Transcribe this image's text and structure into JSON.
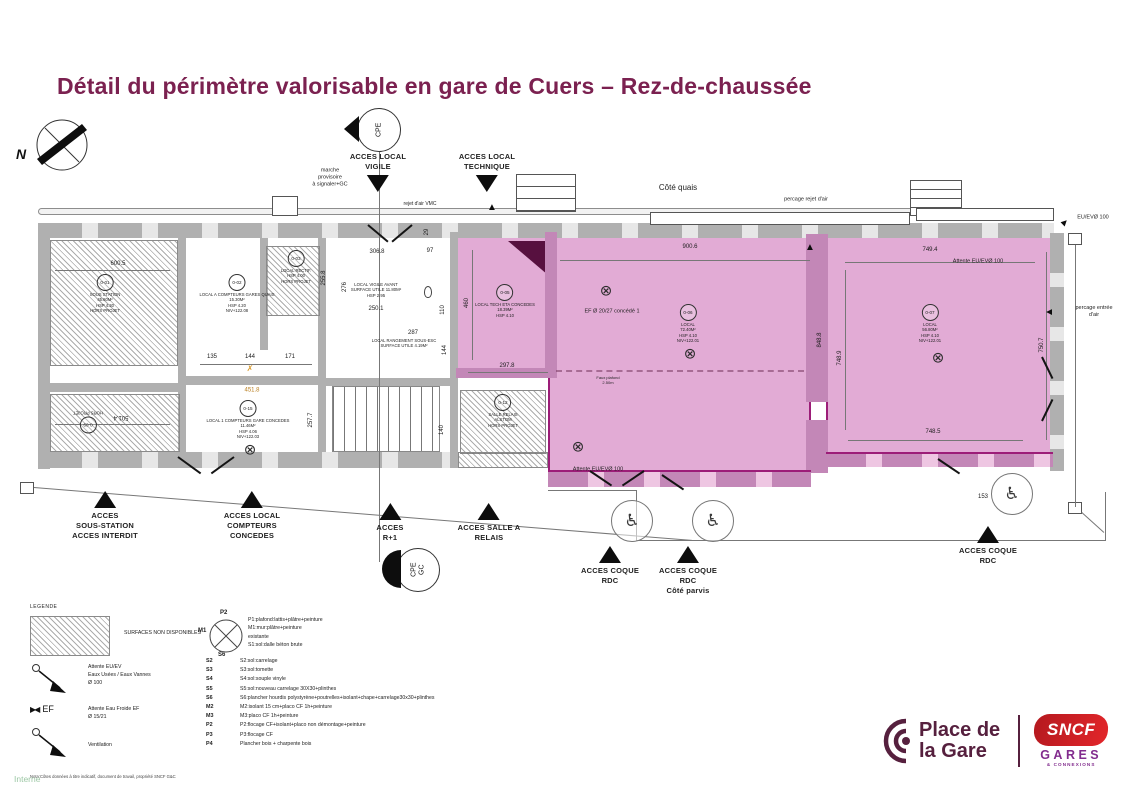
{
  "header": {
    "title": "Détail du périmètre valorisable en gare de Cuers – Rez-de-chaussée"
  },
  "compass": {
    "north": "N"
  },
  "cpe_top": {
    "label": "CPE"
  },
  "cpe_gc": {
    "label": "CPE\nGC"
  },
  "colors": {
    "title": "#7b2150",
    "valorisable_fill": "#e2abd5",
    "valorisable_outline": "#9c1d78",
    "wall_grey": "#b0b0b0",
    "sncf_red": "#d2232a",
    "gares_purple": "#822c8e",
    "logo_maroon": "#56203e",
    "interne_green": "#9cc7a4"
  },
  "plan": {
    "dimensions": [
      {
        "t": "900.6",
        "x": 690,
        "y": 247
      },
      {
        "t": "749.4",
        "x": 930,
        "y": 250
      },
      {
        "t": "748.5",
        "x": 933,
        "y": 432
      },
      {
        "t": "748.9",
        "x": 840,
        "y": 358,
        "r": -90
      },
      {
        "t": "750.7",
        "x": 1042,
        "y": 345,
        "r": -90
      },
      {
        "t": "848.8",
        "x": 820,
        "y": 340,
        "r": -90
      },
      {
        "t": "460",
        "x": 467,
        "y": 303,
        "r": -90
      },
      {
        "t": "297.8",
        "x": 507,
        "y": 366
      },
      {
        "t": "306.8",
        "x": 377,
        "y": 252
      },
      {
        "t": "250.1",
        "x": 376,
        "y": 309
      },
      {
        "t": "276",
        "x": 345,
        "y": 287,
        "r": -90
      },
      {
        "t": "110",
        "x": 443,
        "y": 310,
        "r": -90
      },
      {
        "t": "97",
        "x": 430,
        "y": 251
      },
      {
        "t": "29",
        "x": 427,
        "y": 232,
        "r": -90
      },
      {
        "t": "287",
        "x": 413,
        "y": 333
      },
      {
        "t": "144",
        "x": 445,
        "y": 350,
        "r": -90
      },
      {
        "t": "140",
        "x": 442,
        "y": 430,
        "r": -90
      },
      {
        "t": "135",
        "x": 212,
        "y": 357
      },
      {
        "t": "144",
        "x": 250,
        "y": 357
      },
      {
        "t": "171",
        "x": 290,
        "y": 357
      },
      {
        "t": "600.5",
        "x": 118,
        "y": 264
      },
      {
        "t": "501.4",
        "x": 121,
        "y": 417,
        "r": 180
      },
      {
        "t": "257.7",
        "x": 311,
        "y": 420,
        "r": -90
      },
      {
        "t": "255.8",
        "x": 324,
        "y": 278,
        "r": -90
      },
      {
        "t": "153",
        "x": 983,
        "y": 497
      }
    ],
    "notes": [
      {
        "t": "marche\nprovisoire\nà signaler+GC",
        "x": 330,
        "y": 178,
        "s": 5.5
      },
      {
        "t": "rejet d'air VMC",
        "x": 420,
        "y": 204,
        "s": 5
      },
      {
        "t": "Côté quais",
        "x": 678,
        "y": 188,
        "s": 8
      },
      {
        "t": "percage rejet d'air",
        "x": 806,
        "y": 200,
        "s": 5.5
      },
      {
        "t": "EU/EVØ 100",
        "x": 1093,
        "y": 218,
        "s": 5.5
      },
      {
        "t": "Attente EU/EVØ 100",
        "x": 978,
        "y": 262,
        "s": 5.5
      },
      {
        "t": "percage entrée d'air",
        "x": 1094,
        "y": 312,
        "s": 5.5
      },
      {
        "t": "EF Ø 20/27 concédé 1",
        "x": 612,
        "y": 312,
        "s": 5.5
      },
      {
        "t": "Attente EU/EVØ 100",
        "x": 598,
        "y": 470,
        "s": 5.5
      },
      {
        "t": "Faux plafond\n2.50m",
        "x": 608,
        "y": 380,
        "s": 4
      },
      {
        "t": "LOCAL VIGILE AVANT\nSURFACE UTILE 11.80M²\nHSP 2.95",
        "x": 376,
        "y": 290,
        "s": 4.3
      },
      {
        "t": "LOCAL RANGEMENT SOUS-ESC\nSURFACE UTILE 4.19M²",
        "x": 404,
        "y": 343,
        "s": 4.2
      },
      {
        "t": "451.8",
        "x": 252,
        "y": 391,
        "s": 6,
        "c": "#b97e1e"
      },
      {
        "t": "✗",
        "x": 250,
        "y": 369,
        "s": 8,
        "c": "#d99a2b"
      }
    ],
    "arrows": [
      {
        "x": 810,
        "y": 248,
        "r": 0
      },
      {
        "x": 1064,
        "y": 223,
        "r": 45
      },
      {
        "x": 1050,
        "y": 312,
        "r": -90
      },
      {
        "x": 492,
        "y": 208,
        "r": 0
      }
    ],
    "lights": [
      {
        "x": 606,
        "y": 291
      },
      {
        "x": 690,
        "y": 354
      },
      {
        "x": 578,
        "y": 447
      },
      {
        "x": 938,
        "y": 358
      },
      {
        "x": 250,
        "y": 450
      }
    ],
    "wheelchairs": [
      {
        "x": 632,
        "y": 521
      },
      {
        "x": 713,
        "y": 521
      },
      {
        "x": 1012,
        "y": 494
      }
    ],
    "rooms": [
      {
        "id": "0-01",
        "text": "SOUS STATION\n45.80M²\nHSP 4.30\nHORS PROJET",
        "x": 105,
        "y": 282
      },
      {
        "id": "0-02",
        "text": "LOCAL A COMPTEURS GARES QUAIS\n15.30M²\nHSP 4.20\nNIV+122.08",
        "x": 237,
        "y": 282
      },
      {
        "id": "0-03",
        "text": "LOCAL RECTIF.\nHSP 4.00\nHORS PROJET",
        "x": 296,
        "y": 258
      },
      {
        "id": "0-05",
        "text": "LOCAL TECH ETA CONCEDES\n18.39M²\nHSP 4.10",
        "x": 505,
        "y": 292
      },
      {
        "id": "0-06",
        "text": "LOCAL\n72.40M²\nHSP 4.10\nNIV+122.01",
        "x": 688,
        "y": 312
      },
      {
        "id": "0-07",
        "text": "LOCAL\n56.80M²\nHSP 4.10\nNIV+122.01",
        "x": 930,
        "y": 312
      },
      {
        "id": "0-09",
        "text": "HORS PROJET",
        "x": 88,
        "y": 418,
        "rot": 180
      },
      {
        "id": "0-12",
        "text": "SALLE RELAIS\nALSTOM\nHORS PROJET",
        "x": 503,
        "y": 402
      },
      {
        "id": "0-15",
        "text": "LOCAL 1 COMPTEURS GARE CONCEDES\n11.46M²\nHSP 4.06\nNIV+122.03",
        "x": 248,
        "y": 408
      }
    ],
    "access": [
      {
        "t": "ACCES LOCAL\nVIGILE",
        "x": 378,
        "y": 152,
        "dir": "down"
      },
      {
        "t": "ACCES LOCAL\nTECHNIQUE",
        "x": 487,
        "y": 152,
        "dir": "down"
      },
      {
        "t": "ACCES\nSOUS-STATION\nACCES INTERDIT",
        "x": 105,
        "y": 488,
        "dir": "up"
      },
      {
        "t": "ACCES LOCAL\nCOMPTEURS\nCONCEDES",
        "x": 252,
        "y": 488,
        "dir": "up"
      },
      {
        "t": "ACCES\nR+1",
        "x": 390,
        "y": 500,
        "dir": "up"
      },
      {
        "t": "ACCES SALLE A\nRELAIS",
        "x": 489,
        "y": 500,
        "dir": "up"
      },
      {
        "t": "ACCES COQUE\nRDC",
        "x": 610,
        "y": 543,
        "dir": "up"
      },
      {
        "t": "ACCES COQUE\nRDC\nCôté parvis",
        "x": 688,
        "y": 543,
        "dir": "up"
      },
      {
        "t": "ACCES COQUE\nRDC",
        "x": 988,
        "y": 523,
        "dir": "up"
      }
    ]
  },
  "legend": {
    "title": "LEGENDE",
    "hatch_label": "SURFACES NON DISPONIBLES",
    "eu_ev": "Attente EU/EV\nEaux Usées / Eaux Vannes\nØ 100",
    "ef_symbol": "EF",
    "ef": "Attente Eau Froide EF\nØ 15/21",
    "ventilation": "Ventilation",
    "note": "Nota:Côtes données à titre indicatif, document de travail, propriété SNCF G&C"
  },
  "materials": {
    "symbol": {
      "top": "P2",
      "left": "M1",
      "bottom": "S6"
    },
    "header": "P1:plafond:lattis+plâtre+peinture\nM1:mur:plâtre+peinture existante\nS1:sol:dalle béton brute",
    "rows": [
      {
        "code": "S2",
        "desc": "S2:sol:carrelage"
      },
      {
        "code": "S3",
        "desc": "S3:sol:tomette"
      },
      {
        "code": "S4",
        "desc": "S4:sol:souple vinyle"
      },
      {
        "code": "S5",
        "desc": "S5:sol:nouveau carrelage 30X30+plinthes"
      },
      {
        "code": "S6",
        "desc": "S6:plancher hourdis polystyrène+poutrelles+isolant+chape+carrelage30x30+plinthes"
      },
      {
        "code": "M2",
        "desc": "M2:isolant 15 cm+placo CF 1h+peinture"
      },
      {
        "code": "M3",
        "desc": "M3:placo CF 1h+peinture"
      },
      {
        "code": "P2",
        "desc": "P2:flocage CF+isolant+placo non démontage+peinture"
      },
      {
        "code": "P3",
        "desc": "P3:flocage CF"
      },
      {
        "code": "P4",
        "desc": "Plancher bois + charpente bois"
      }
    ]
  },
  "branding": {
    "place_de_la_gare": "Place de\nla Gare",
    "sncf": "SNCF",
    "gares": "GARES",
    "connexions": "& CONNEXIONS"
  },
  "footer": {
    "classification": "Interne"
  }
}
